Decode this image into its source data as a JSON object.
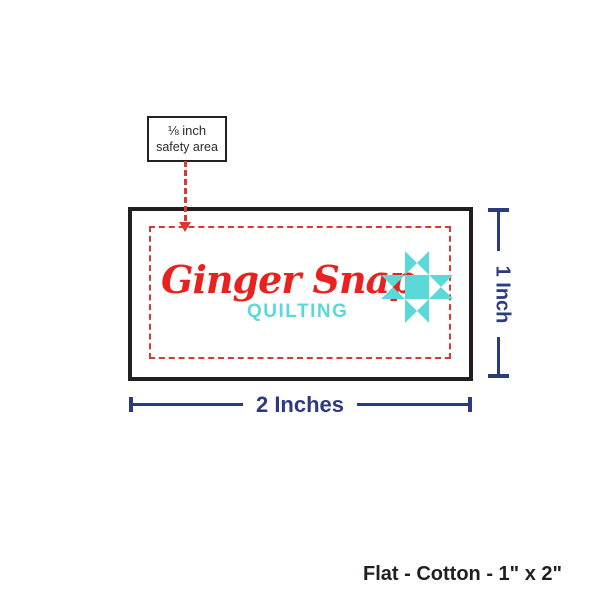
{
  "colors": {
    "brand_red": "#e8231f",
    "dash_red": "#d53b34",
    "teal": "#5bd9d9",
    "navy": "#2b3b7c",
    "outline": "#231f20"
  },
  "callout": {
    "line1": "⅛ inch",
    "line2": "safety area"
  },
  "label": {
    "brand_name": "Ginger Snap",
    "brand_subtitle": "QUILTING",
    "star_icon": "ohio-quilt-star"
  },
  "dimensions": {
    "width_label": "2 Inches",
    "height_label": "1 Inch"
  },
  "caption": "Flat - Cotton - 1\" x 2\""
}
